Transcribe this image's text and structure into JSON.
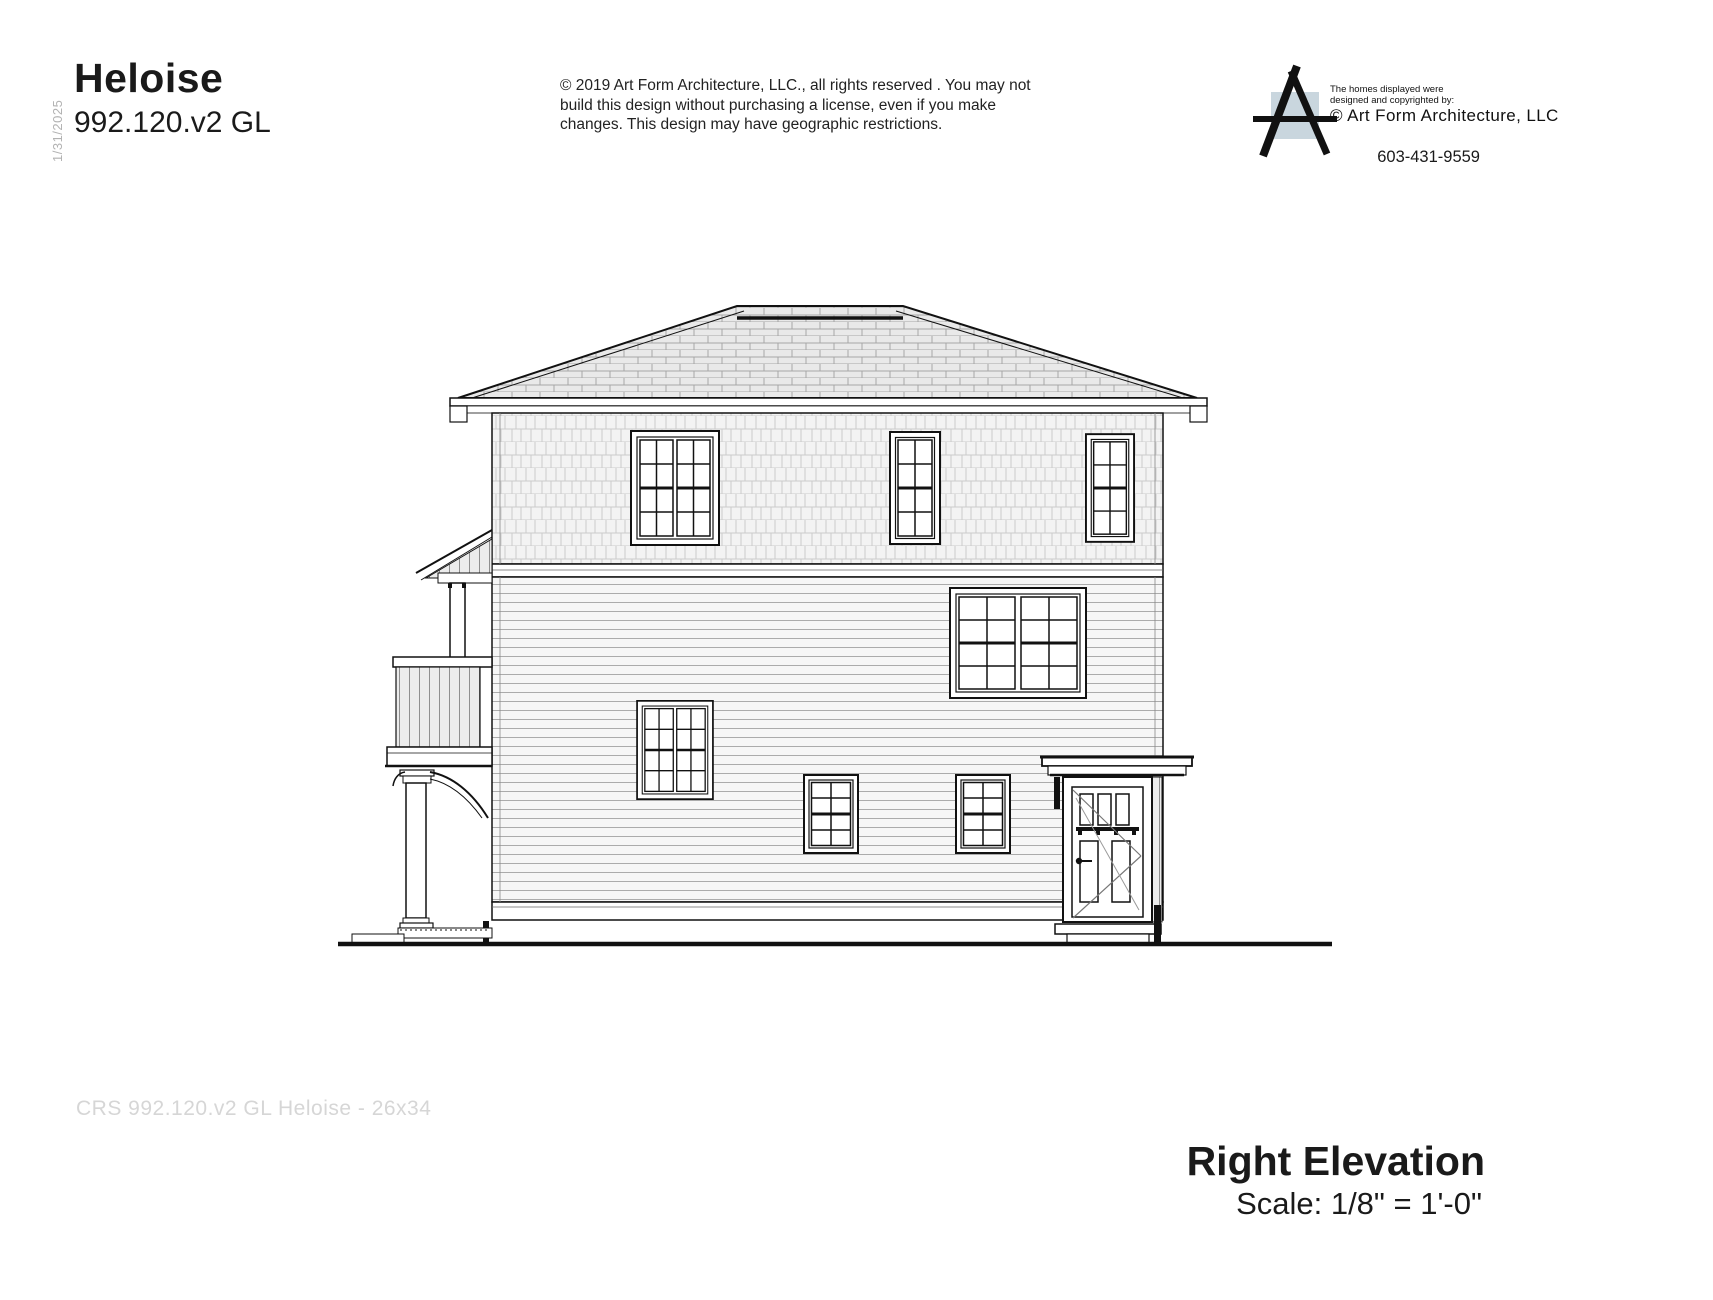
{
  "header": {
    "date_vertical": "1/31/2025",
    "plan_title": "Heloise",
    "plan_number": "992.120.v2 GL",
    "copyright_notice": "© 2019 Art Form Architecture, LLC., all rights reserved . You may not build this design without purchasing a license, even if you make changes. This design may have geographic restrictions.",
    "brand": {
      "tagline_line1": "The homes displayed were",
      "tagline_line2": "designed and copyrighted by:",
      "company_credit": "© Art Form Architecture, LLC",
      "phone": "603-431-9559",
      "logo_square_color": "#c9d6de"
    }
  },
  "title_block": {
    "view_name": "Right Elevation",
    "scale_note": "Scale: 1/8\" = 1'-0\""
  },
  "footer": {
    "watermark": "CRS 992.120.v2 GL Heloise - 26x34"
  }
}
